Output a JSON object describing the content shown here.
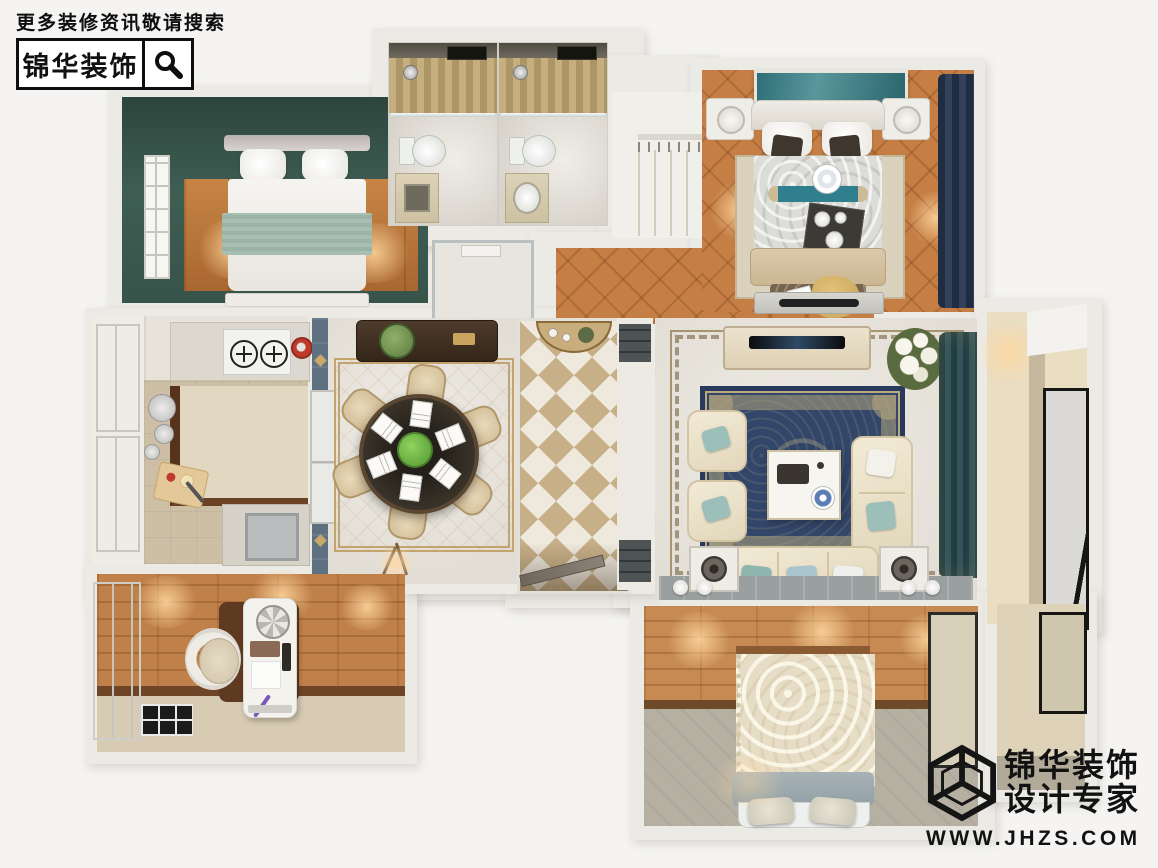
{
  "header": {
    "tagline": "更多装修资讯敬请搜索",
    "brand": "锦华装饰"
  },
  "watermark": {
    "brand": "锦华装饰",
    "tagline": "设计专家",
    "website": "WWW.JHZS.COM"
  },
  "icons": {
    "search": "magnifier-icon",
    "logo": "isometric-cube-logo"
  },
  "palette": {
    "background": "#f5f4f2",
    "wall": "#eceae5",
    "bedroom_teal_wall": "#3e5d53",
    "wood_floor": "#b97539",
    "parquet_floor": "#c57f45",
    "marble_floor": "#ece9e3",
    "tile_gold": "#c7af87",
    "rug_navy": "#32466a",
    "curtain_navy": "#26344d",
    "curtain_teal": "#24444c",
    "accent_sage": "#a6bcb1",
    "accent_teal": "#2f7f8e",
    "logo_black": "#121212"
  },
  "floorplan": {
    "view": "top-down-3d-apartment-render",
    "rooms": [
      "bedroom-top-left",
      "bathroom-1",
      "bathroom-2",
      "walk-in-closet",
      "master-bedroom",
      "corridor",
      "kitchen",
      "kitchen-balcony",
      "dining-room",
      "entry-hall",
      "passage",
      "living-room",
      "balcony-right",
      "study",
      "bedroom-bottom-right",
      "balcony-bottom-right",
      "service-deck"
    ]
  }
}
